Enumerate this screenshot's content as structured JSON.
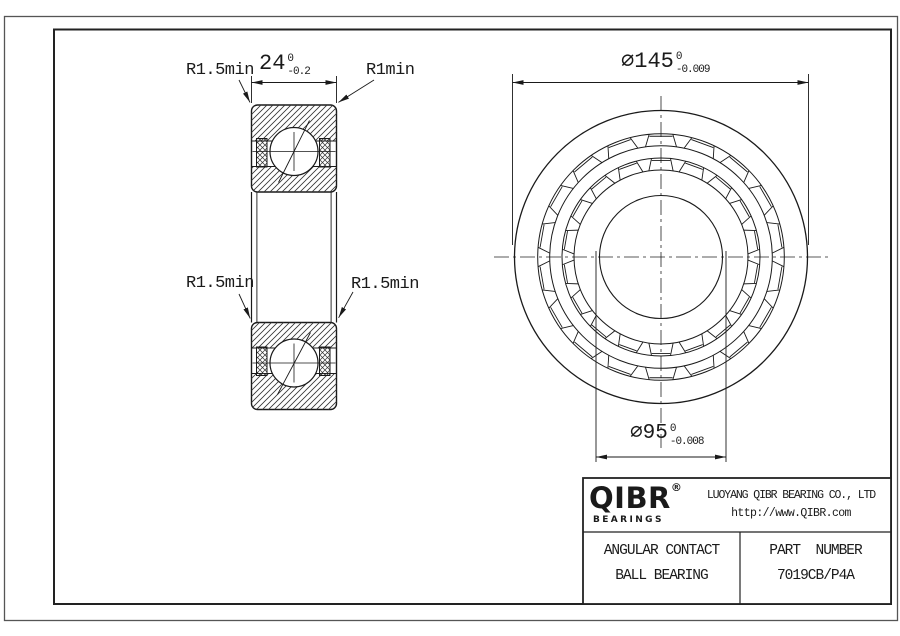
{
  "drawing_labels": {
    "width_dim": {
      "value": "24",
      "tol_upper": "0",
      "tol_lower": "-0.2"
    },
    "od_dim": {
      "value": "⌀145",
      "tol_upper": "0",
      "tol_lower": "-0.009"
    },
    "bore_dim": {
      "value": "⌀95",
      "tol_upper": "0",
      "tol_lower": "-0.008"
    },
    "fillet_top_left": "R1.5min",
    "fillet_top_right": "R1min",
    "fillet_mid_left": "R1.5min",
    "fillet_mid_right": "R1.5min"
  },
  "title_block": {
    "logo_text": "QIBR",
    "logo_reg": "®",
    "logo_subtext": "BEARINGS",
    "company_name": "LUOYANG QIBR BEARING CO., LTD",
    "website": "http://www.QIBR.com",
    "product_name_line1": "ANGULAR CONTACT",
    "product_name_line2": "BALL BEARING",
    "part_number_label": "PART  NUMBER",
    "part_number": "7019CB/P4A"
  },
  "colors": {
    "line": "#1a1a1a",
    "background": "#ffffff"
  }
}
